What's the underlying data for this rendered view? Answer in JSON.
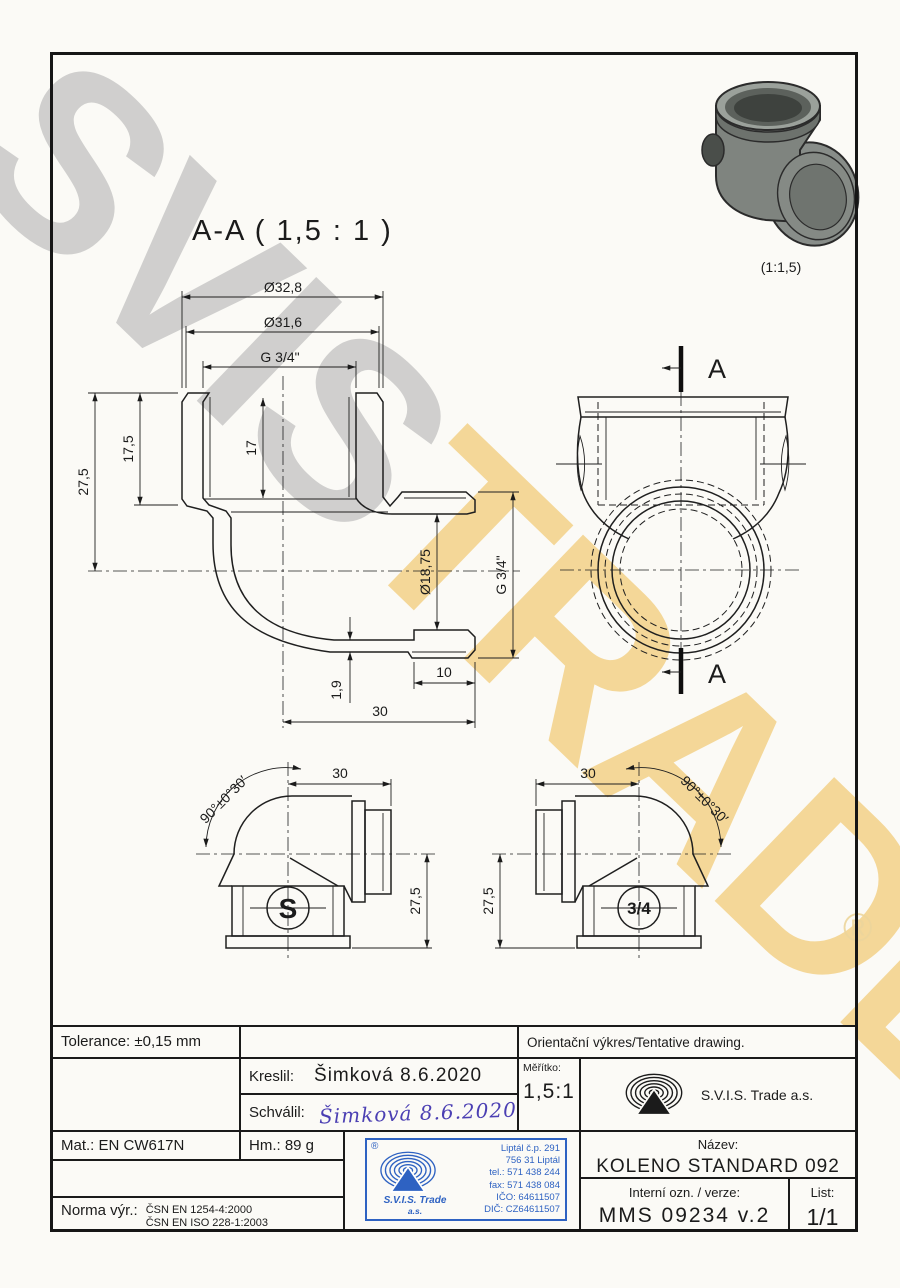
{
  "watermark": {
    "word1": "SVIS",
    "word2": "TRADE",
    "registered_mark": "®"
  },
  "photo": {
    "scale_label": "(1:1,5)"
  },
  "section_view": {
    "title": "A-A ( 1,5 : 1 )",
    "cut_label": "A"
  },
  "dims": {
    "dia_outer": "Ø32,8",
    "dia_mid": "Ø31,6",
    "thread_top": "G 3/4\"",
    "height_total": "27,5",
    "depth_socket": "17,5",
    "thread_len": "17",
    "bore": "Ø18,75",
    "thread_side": "G 3/4\"",
    "wall": "1,9",
    "spigot_len": "10",
    "center_to_face": "30"
  },
  "side_views": {
    "length": "30",
    "height": "27,5",
    "angle": "90°±0°30′",
    "mark_left": "S",
    "mark_right": "3/4"
  },
  "title_block": {
    "tolerance": "Tolerance: ±0,15 mm",
    "note": "Orientační výkres/Tentative drawing.",
    "kreslil_label": "Kreslil:",
    "kreslil_value": "Šimková 8.6.2020",
    "schvalil_label": "Schválil:",
    "schvalil_value": "Šimková 8.6.2020",
    "meritko_label": "Měřítko:",
    "meritko_value": "1,5:1",
    "company": "S.V.I.S. Trade a.s.",
    "mat": "Mat.: EN CW617N",
    "hm": "Hm.: 89 g",
    "norma_label": "Norma výr.:",
    "norma_line1": "ČSN EN 1254-4:2000",
    "norma_line2": "ČSN EN ISO 228-1:2003",
    "nazev_label": "Název:",
    "nazev_value": "KOLENO STANDARD 092 3/4\"",
    "interni_label": "Interní ozn. / verze:",
    "interni_value": "MMS 09234 v.2",
    "list_label": "List:",
    "list_value": "1/1"
  },
  "stamp": {
    "registered_mark": "®",
    "company_line1": "S.V.I.S. Trade",
    "company_line2": "a.s.",
    "lines": [
      "Liptál č.p. 291",
      "756 31 Liptál",
      "tel.: 571 438 244",
      "fax: 571 438 084",
      "IČO: 64611507",
      "DIČ: CZ64611507"
    ]
  },
  "colors": {
    "stamp_blue": "#2e62c2",
    "signature_ink": "#4b3fb3",
    "watermark_gray": "#c8c8c8",
    "watermark_yellow": "#f2d08a"
  }
}
